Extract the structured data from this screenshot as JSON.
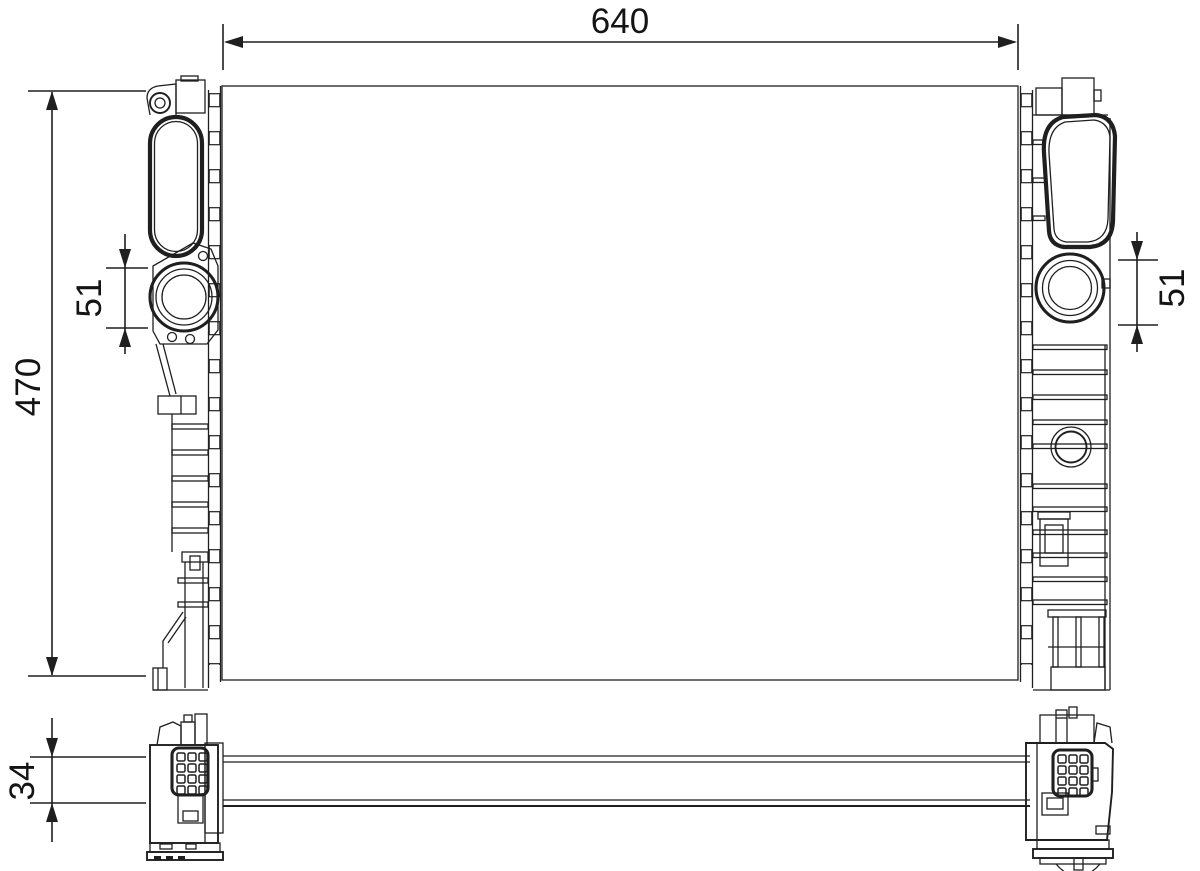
{
  "drawing": {
    "background": "#ffffff",
    "line_color": "#1f1f1f",
    "dimension_labels": {
      "core_width": "640",
      "core_height": "470",
      "left_port": "51",
      "right_port": "51",
      "crossmember_height": "34"
    }
  }
}
